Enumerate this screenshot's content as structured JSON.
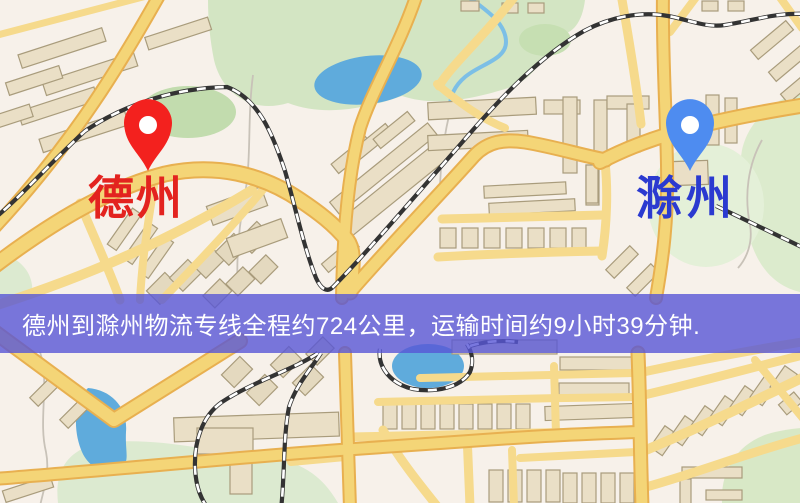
{
  "map": {
    "origin_marker": {
      "label": "德州",
      "label_color": "#e3231f",
      "pin_color": "#f3211e"
    },
    "destination_marker": {
      "label": "滁州",
      "label_color": "#2b3ad0",
      "pin_color": "#4e8cf0"
    }
  },
  "banner": {
    "text": "德州到滁州物流专线全程约724公里，运输时间约9小时39分钟.",
    "background_color": "#5856d6",
    "text_color": "#ffffff"
  },
  "route": {
    "origin": "德州",
    "destination": "滁州",
    "distance_text": "约724公里",
    "duration_text": "约9小时39分钟"
  },
  "palette": {
    "map_background": "#f7f1ea",
    "road_fill": "#f4d577",
    "road_casing": "#e8b050",
    "minor_road": "#f6da8c",
    "building_fill": "#eadfc6",
    "building_stroke": "#a99c7c",
    "green_area": "#d3e5c3",
    "water": "#5fabdc",
    "railway_dark": "#333333"
  }
}
